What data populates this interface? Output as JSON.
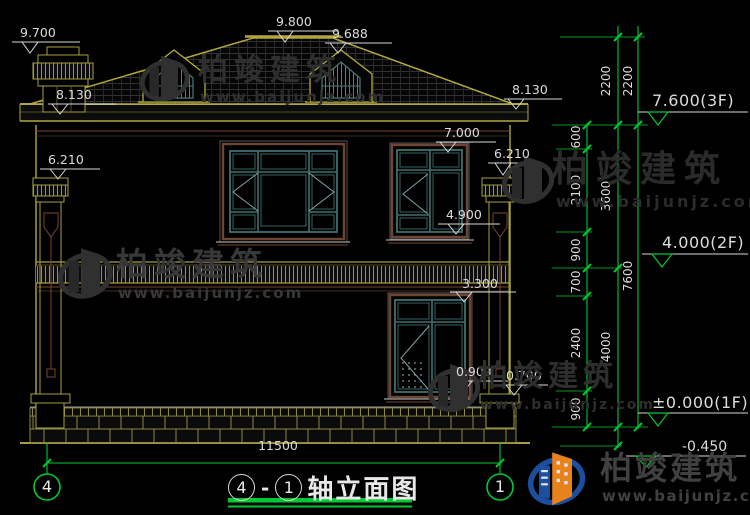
{
  "markers": {
    "chimney_top": "9.700",
    "ridge": "9.800",
    "dormer": "9.688",
    "eave_left": "8.130",
    "eave_right": "8.130",
    "win2f_top": "7.000",
    "capital_left": "6.210",
    "capital_right": "6.210",
    "win2f_bottom": "4.900",
    "win1f_top": "3.300",
    "win1f_bottom": "0.900",
    "pedestal_top": "0.700",
    "level_3f": "7.600(3F)",
    "level_2f": "4.000(2F)",
    "level_1f": "±0.000(1F)",
    "level_ground": "-0.450"
  },
  "dimensions": {
    "chain_inner": [
      "600",
      "2100",
      "900",
      "700",
      "2400",
      "900"
    ],
    "chain_mid": [
      "2200",
      "3600",
      "4000"
    ],
    "chain_outer": [
      "2200",
      "7600"
    ],
    "total_width": "11500"
  },
  "axis_bubbles": {
    "left": "4",
    "right": "1"
  },
  "title": {
    "axis_left": "4",
    "separator": "-",
    "axis_right": "1",
    "name": "轴立面图"
  },
  "watermark": {
    "brand": "柏竣建筑",
    "site": "www.baijunjz.com"
  }
}
